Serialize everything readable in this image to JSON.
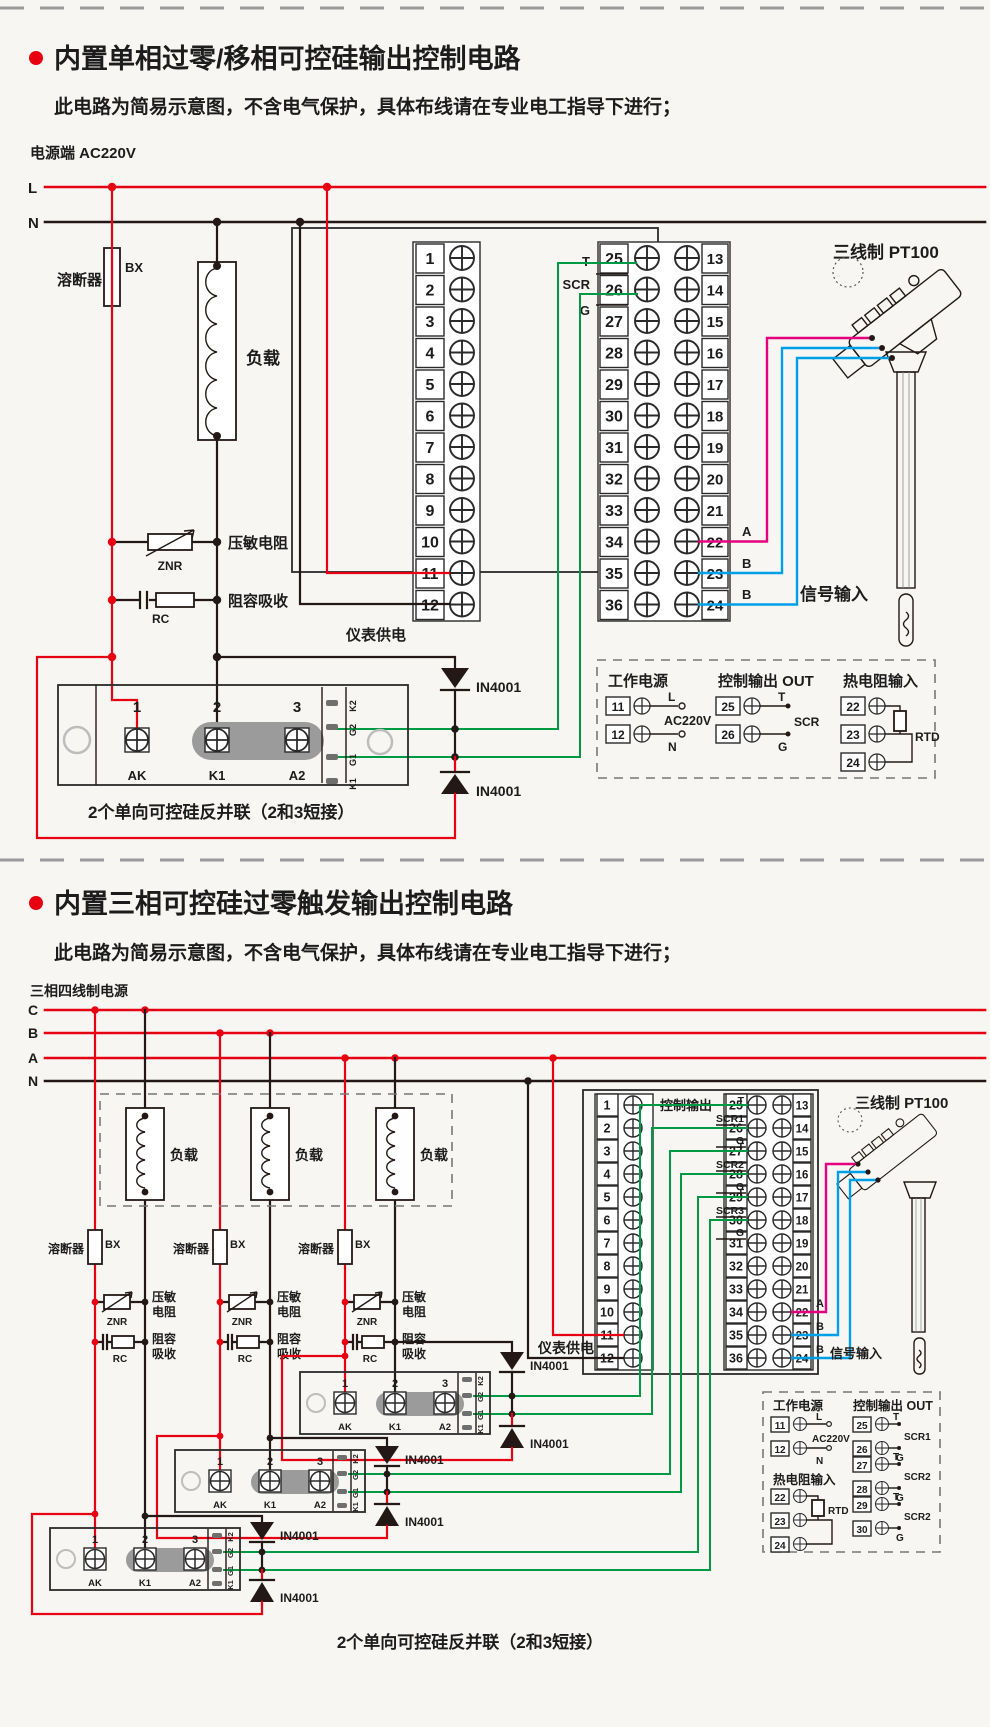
{
  "colors": {
    "red": "#e60012",
    "green": "#009944",
    "magenta": "#e4007f",
    "cyan": "#00a0e9",
    "ink": "#231815",
    "gray_blob": "#9b9b9b",
    "background": "#f7f6f3"
  },
  "s1": {
    "title": "内置单相过零/移相可控硅输出控制电路",
    "subtitle": "此电路为简易示意图，不含电气保护，具体布线请在专业电工指导下进行；",
    "power_label": "电源端  AC220V",
    "line_l": "L",
    "line_n": "N",
    "fuse_label": "溶断器",
    "fuse_code": "BX",
    "load_label": "负载",
    "znr_label": "压敏电阻",
    "znr_code": "ZNR",
    "rc_label": "阻容吸收",
    "rc_code": "RC",
    "supply_label": "仪表供电",
    "terminals_left": [
      "1",
      "2",
      "3",
      "4",
      "5",
      "6",
      "7",
      "8",
      "9",
      "10",
      "11",
      "12"
    ],
    "rows_mid": [
      {
        "m": "25",
        "r": "13"
      },
      {
        "m": "26",
        "r": "14"
      },
      {
        "m": "27",
        "r": "15"
      },
      {
        "m": "28",
        "r": "16"
      },
      {
        "m": "29",
        "r": "17"
      },
      {
        "m": "30",
        "r": "18"
      },
      {
        "m": "31",
        "r": "19"
      },
      {
        "m": "32",
        "r": "20"
      },
      {
        "m": "33",
        "r": "21"
      },
      {
        "m": "34",
        "r": "22"
      },
      {
        "m": "35",
        "r": "23"
      },
      {
        "m": "36",
        "r": "24"
      }
    ],
    "out_t": "T",
    "out_scr": "SCR",
    "out_g": "G",
    "sensor_title": "三线制 PT100",
    "wire_a": "A",
    "wire_b1": "B",
    "wire_b2": "B",
    "signal_label": "信号输入",
    "diode_label": "IN4001",
    "ssr": {
      "p1": "1",
      "p2": "2",
      "p3": "3",
      "a": "AK",
      "b": "K1",
      "c": "A2",
      "s1": "K2",
      "s2": "G2",
      "s3": "G1",
      "s4": "K1"
    },
    "caption": "2个单向可控硅反并联（2和3短接）",
    "legend": {
      "title_power": "工作电源",
      "n11": "11",
      "tag_l": "L",
      "n12": "12",
      "tag_n": "N",
      "volt": "AC220V",
      "title_out": "控制输出 OUT",
      "n25": "25",
      "tag_t": "T",
      "n26": "26",
      "tag_scr": "SCR",
      "tag_g": "G",
      "title_rtd": "热电阻输入",
      "n22": "22",
      "n23": "23",
      "n24": "24",
      "rtd": "RTD"
    }
  },
  "s2": {
    "title": "内置三相可控硅过零触发输出控制电路",
    "subtitle": "此电路为简易示意图，不含电气保护，具体布线请在专业电工指导下进行；",
    "power_label": "三相四线制电源",
    "line_c": "C",
    "line_b": "B",
    "line_a": "A",
    "line_n": "N",
    "loads": [
      "负载",
      "负载",
      "负载"
    ],
    "clusters": [
      {
        "fuse_label": "溶断器",
        "fuse_code": "BX",
        "znr1": "压敏",
        "znr2": "电阻",
        "znr_code": "ZNR",
        "rc1": "阻容",
        "rc2": "吸收",
        "rc_code": "RC"
      },
      {
        "fuse_label": "溶断器",
        "fuse_code": "BX",
        "znr1": "压敏",
        "znr2": "电阻",
        "znr_code": "ZNR",
        "rc1": "阻容",
        "rc2": "吸收",
        "rc_code": "RC"
      },
      {
        "fuse_label": "溶断器",
        "fuse_code": "BX",
        "znr1": "压敏",
        "znr2": "电阻",
        "znr_code": "ZNR",
        "rc1": "阻容",
        "rc2": "吸收",
        "rc_code": "RC"
      }
    ],
    "ctrl_label": "控制输出",
    "supply_label": "仪表供电",
    "terminals_left": [
      "1",
      "2",
      "3",
      "4",
      "5",
      "6",
      "7",
      "8",
      "9",
      "10",
      "11",
      "12"
    ],
    "rows_mid": [
      {
        "m": "25",
        "r": "13"
      },
      {
        "m": "26",
        "r": "14"
      },
      {
        "m": "27",
        "r": "15"
      },
      {
        "m": "28",
        "r": "16"
      },
      {
        "m": "29",
        "r": "17"
      },
      {
        "m": "30",
        "r": "18"
      },
      {
        "m": "31",
        "r": "19"
      },
      {
        "m": "32",
        "r": "20"
      },
      {
        "m": "33",
        "r": "21"
      },
      {
        "m": "34",
        "r": "22"
      },
      {
        "m": "35",
        "r": "23"
      },
      {
        "m": "36",
        "r": "24"
      }
    ],
    "out_groups": [
      {
        "t": "T",
        "scr": "SCR1",
        "g": "G"
      },
      {
        "t": "T",
        "scr": "SCR2",
        "g": "G"
      },
      {
        "t": "T",
        "scr": "SCR3",
        "g": "G"
      }
    ],
    "sensor_title": "三线制 PT100",
    "wire_a": "A",
    "wire_b1": "B",
    "wire_b2": "B",
    "signal_label": "信号输入",
    "diode_label": "IN4001",
    "modules": [
      {
        "p1": "1",
        "p2": "2",
        "p3": "3",
        "a": "AK",
        "b": "K1",
        "c": "A2",
        "s1": "K2",
        "s2": "G2",
        "s3": "G1",
        "s4": "K1"
      },
      {
        "p1": "1",
        "p2": "2",
        "p3": "3",
        "a": "AK",
        "b": "K1",
        "c": "A2",
        "s1": "K2",
        "s2": "G2",
        "s3": "G1",
        "s4": "K1"
      },
      {
        "p1": "1",
        "p2": "2",
        "p3": "3",
        "a": "AK",
        "b": "K1",
        "c": "A2",
        "s1": "K2",
        "s2": "G2",
        "s3": "G1",
        "s4": "K1"
      }
    ],
    "legend": {
      "title_power": "工作电源",
      "n11": "11",
      "tag_l": "L",
      "n12": "12",
      "tag_n": "N",
      "volt": "AC220V",
      "title_rtd": "热电阻输入",
      "n22": "22",
      "n23": "23",
      "n24": "24",
      "rtd": "RTD",
      "title_out": "控制输出 OUT",
      "pairs": [
        {
          "n1": "25",
          "t": "T",
          "scr": "SCR1",
          "n2": "26",
          "g": "G"
        },
        {
          "n1": "27",
          "t": "T",
          "scr": "SCR2",
          "n2": "28",
          "g": "G"
        },
        {
          "n1": "29",
          "t": "T",
          "scr": "SCR2",
          "n2": "30",
          "g": "G"
        }
      ]
    },
    "caption": "2个单向可控硅反并联（2和3短接）"
  }
}
